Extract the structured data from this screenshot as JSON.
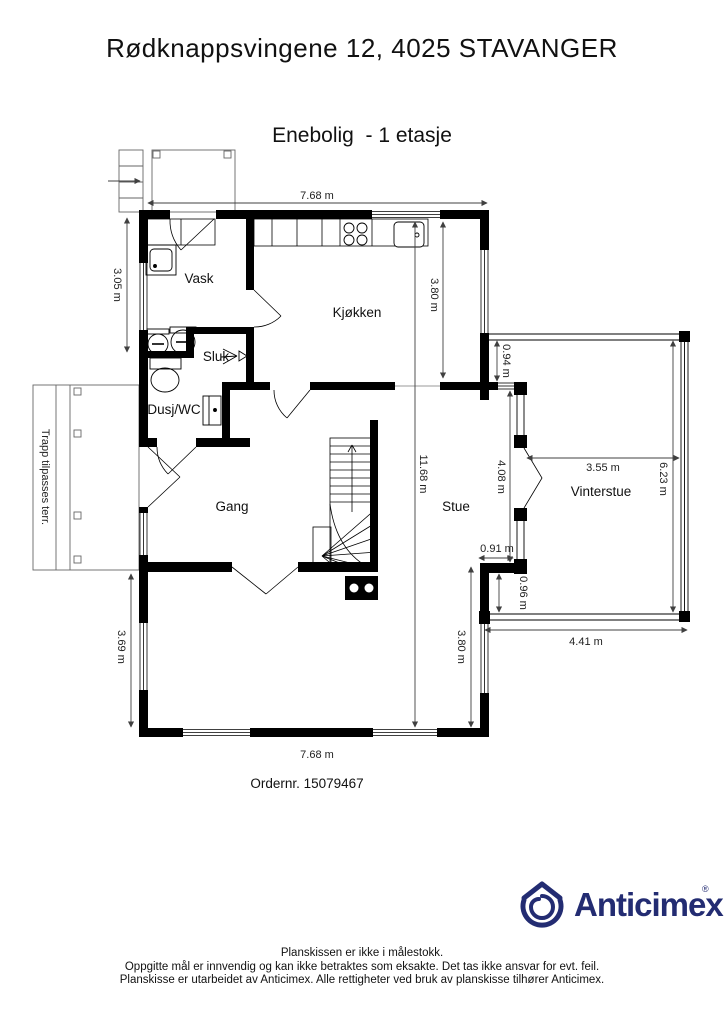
{
  "header": {
    "title": "Rødknappsvingene 12, 4025 STAVANGER",
    "subtitle": "Enebolig  - 1 etasje"
  },
  "rooms": {
    "vask": "Vask",
    "kjokken": "Kjøkken",
    "sluk": "Sluk",
    "dusj_wc": "Dusj/WC",
    "gang": "Gang",
    "stue": "Stue",
    "vinterstue": "Vinterstue"
  },
  "dimensions": {
    "top_width": "7.68 m",
    "vask_height": "3.05 m",
    "kitchen_height": "3.80 m",
    "total_height": "11.68 m",
    "vs_offset_top": "0.94 m",
    "vs_door_span": "4.08 m",
    "vs_inner_width": "3.55 m",
    "vs_height": "6.23 m",
    "jog_width": "0.91 m",
    "jog_height": "0.96 m",
    "vs_bottom_width": "4.41 m",
    "stue_left_height": "3.69 m",
    "stue_right_height": "3.80 m",
    "bottom_width": "7.68 m"
  },
  "annotations": {
    "deck": "Trapp tilpasses terr.",
    "order_no": "Ordernr. 15079467"
  },
  "footer": {
    "brand": "Anticimex",
    "registered": "®",
    "lines": [
      "Planskissen er ikke i målestokk.",
      "Oppgitte mål er innvendig og kan ikke betraktes som eksakte. Det tas ikke ansvar for evt. feil.",
      "Planskisse er utarbeidet av Anticimex. Alle rettigheter ved bruk av planskisse tilhører Anticimex."
    ]
  },
  "colors": {
    "wall": "#000000",
    "dimension": "#404040",
    "brand_navy": "#232c72"
  }
}
